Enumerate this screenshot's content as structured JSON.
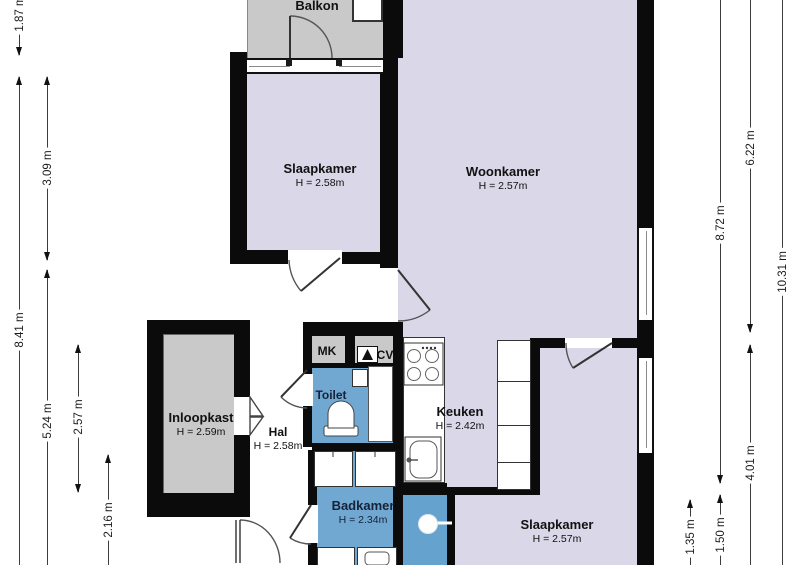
{
  "plan": {
    "title": "Floor plan (apartment)",
    "rooms": {
      "balkon": {
        "label": "Balkon"
      },
      "slaapkamer1": {
        "label": "Slaapkamer",
        "height": "H = 2.58m"
      },
      "woonkamer": {
        "label": "Woonkamer",
        "height": "H = 2.57m"
      },
      "inloopkast": {
        "label": "Inloopkast",
        "height": "H = 2.59m"
      },
      "hal": {
        "label": "Hal",
        "height": "H = 2.58m"
      },
      "mk": {
        "label": "MK"
      },
      "cv": {
        "label": "CV"
      },
      "toilet": {
        "label": "Toilet"
      },
      "keuken": {
        "label": "Keuken",
        "height": "H = 2.42m"
      },
      "badkamer": {
        "label": "Badkamer",
        "height": "H = 2.34m"
      },
      "slaapkamer2": {
        "label": "Slaapkamer",
        "height": "H = 2.57m"
      }
    },
    "dimensions": {
      "left": {
        "d187": "1.87 m",
        "d841": "8.41 m",
        "d309": "3.09 m",
        "d524": "5.24 m",
        "d257": "2.57 m",
        "d216": "2.16 m"
      },
      "right": {
        "d622": "6.22 m",
        "d872": "8.72 m",
        "d1031": "10.31 m",
        "d401": "4.01 m",
        "d135": "1.35 m",
        "d150": "1.50 m"
      }
    },
    "colors": {
      "wall": "#0b0b0b",
      "room": "#d9d7e8",
      "wet": "#71a8d2",
      "shower": "#66a2ce",
      "service": "#c9c9c9",
      "dimline": "#3c3c3c"
    }
  }
}
